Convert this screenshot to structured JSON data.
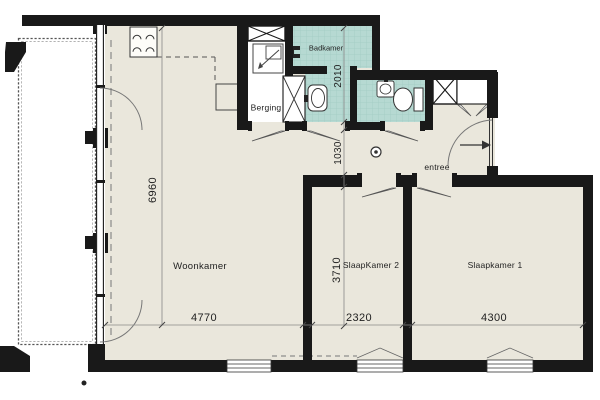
{
  "floorplan": {
    "rooms": {
      "woonkamer": {
        "label": "Woonkamer"
      },
      "slaapkamer1": {
        "label": "Slaapkamer 1"
      },
      "slaapkamer2": {
        "label": "SlaapKamer 2"
      },
      "badkamer": {
        "label": "Badkamer"
      },
      "berging": {
        "label": "Berging"
      },
      "entree": {
        "label": "entree"
      }
    },
    "dimensions_mm": {
      "woonkamer_depth": "6960",
      "woonkamer_width": "4770",
      "badkamer_depth": "2010",
      "hal_depth": "1030",
      "slaapkamer2_depth": "3710",
      "slaapkamer2_width": "2320",
      "slaapkamer1_width": "4300"
    },
    "colors": {
      "wall": "#191919",
      "floor": "#eae7dc",
      "tile": "#b6d9d2",
      "tile_grid": "#a2ccc4",
      "line": "#555555",
      "background": "#ffffff"
    }
  }
}
